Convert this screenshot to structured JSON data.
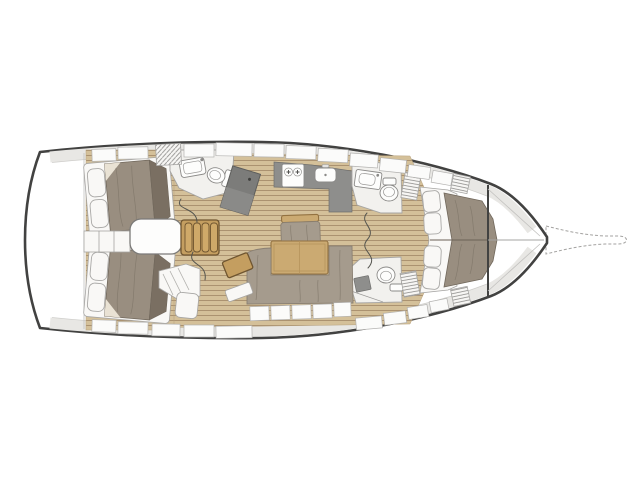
{
  "diagram": {
    "type": "yacht-floor-plan",
    "view": "top-down interior layout, bow to the right, stern to the left",
    "areas": [
      {
        "id": "swim-platform",
        "label": "Transom / swim platform"
      },
      {
        "id": "aft-cabin-port",
        "label": "Aft double cabin (port) with bed and two pillows"
      },
      {
        "id": "aft-cabin-starboard",
        "label": "Aft double cabin (starboard) with bed and two pillows"
      },
      {
        "id": "engine-box",
        "label": "Engine box under companionway"
      },
      {
        "id": "companionway-steps",
        "label": "Companionway steps (4 wooden treads)"
      },
      {
        "id": "aft-head",
        "label": "Aft head with sink and toilet"
      },
      {
        "id": "nav-station",
        "label": "Angled chart table / nav station"
      },
      {
        "id": "galley",
        "label": "Galley with 2-burner stove and sink"
      },
      {
        "id": "saloon",
        "label": "Saloon with wooden table, bench and U-shaped settee"
      },
      {
        "id": "vanity-seat",
        "label": "Vanity desk with seat (starboard aft)"
      },
      {
        "id": "forward-head-port",
        "label": "Forward head (port) with sink and toilet"
      },
      {
        "id": "forward-head-starboard",
        "label": "Forward head (starboard) with toilet and shower seat"
      },
      {
        "id": "forward-cabin",
        "label": "Forward V-berth cabin with four pillows"
      },
      {
        "id": "bow-locker",
        "label": "Bow anchor locker"
      },
      {
        "id": "bowsprit",
        "label": "Bowsprit"
      }
    ]
  },
  "colors": {
    "hull_outline": "#424241",
    "deck_band": "#e8e7e4",
    "room": "#f2f1ee",
    "white_box": "#f9f8f6",
    "wood_floor": "#d4c099",
    "wood_line": "#ab9270",
    "wood_step": "#c49e60",
    "wood_step_border": "#6f5530",
    "wood_table": "#cbaa72",
    "wood_table_border": "#937241",
    "mattress": "#998e80",
    "mattress_dark": "#7a6f62",
    "mattress_border": "#71685c",
    "cushion": "#a59b8d",
    "cushion_border": "#8a8073",
    "pillow": "#f9f8f6",
    "pillow_border": "#a9a8a6",
    "counter": "#8e8e8c",
    "chart_table": "#7c7c7a",
    "outline_soft": "#a6a5a3",
    "bowsprit": "#a3a2a0"
  }
}
